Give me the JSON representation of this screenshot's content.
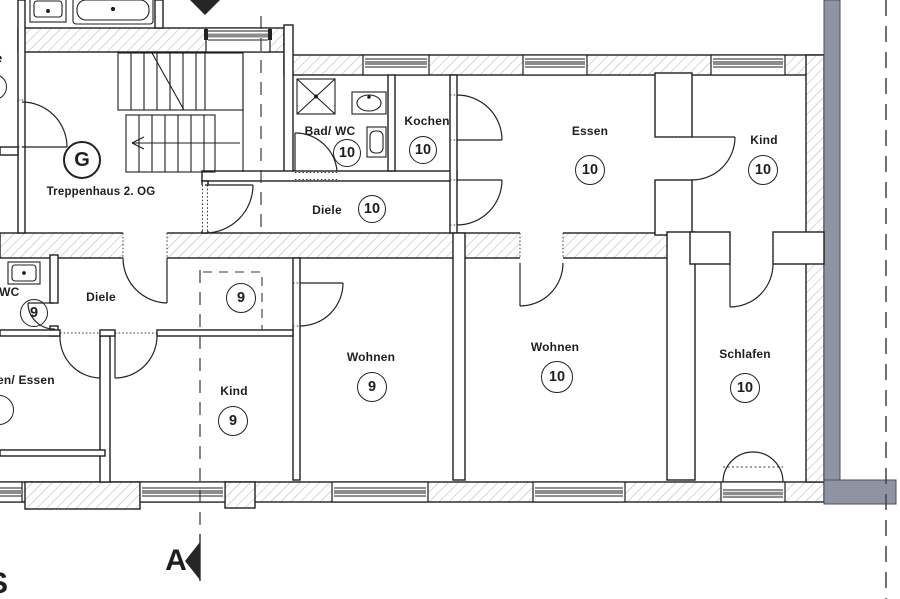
{
  "plan": {
    "stairwell": {
      "letter": "G",
      "name": "Treppenhaus 2. OG"
    },
    "rooms": {
      "bad_wc": {
        "label": "Bad/ WC",
        "number": "10"
      },
      "kochen": {
        "label": "Kochen",
        "number": "10"
      },
      "diele_og": {
        "label": "Diele",
        "number": "10"
      },
      "essen": {
        "label": "Essen",
        "number": "10"
      },
      "kind_10": {
        "label": "Kind",
        "number": "10"
      },
      "wc_9": {
        "label": "/ WC",
        "number": "9"
      },
      "diele_9": {
        "label": "Diele",
        "number": "9"
      },
      "wohnen_essen": {
        "label": "en/ Essen"
      },
      "kind_9": {
        "label": "Kind",
        "number": "9"
      },
      "wohnen_9": {
        "label": "Wohnen",
        "number": "9"
      },
      "wohnen_10": {
        "label": "Wohnen",
        "number": "10"
      },
      "schlafen": {
        "label": "Schlafen",
        "number": "10"
      }
    },
    "markers": {
      "section_label": "A",
      "edge_text_bottom_left": "S",
      "edge_text_top_left": "e"
    },
    "colors": {
      "wall_line": "#1f1f1f",
      "hatch": "#b8b8b8",
      "neighbor_wall_gray": "#8e94a3",
      "window_glass": "#8c8c8c",
      "dash_line": "#3a3a3a"
    }
  }
}
